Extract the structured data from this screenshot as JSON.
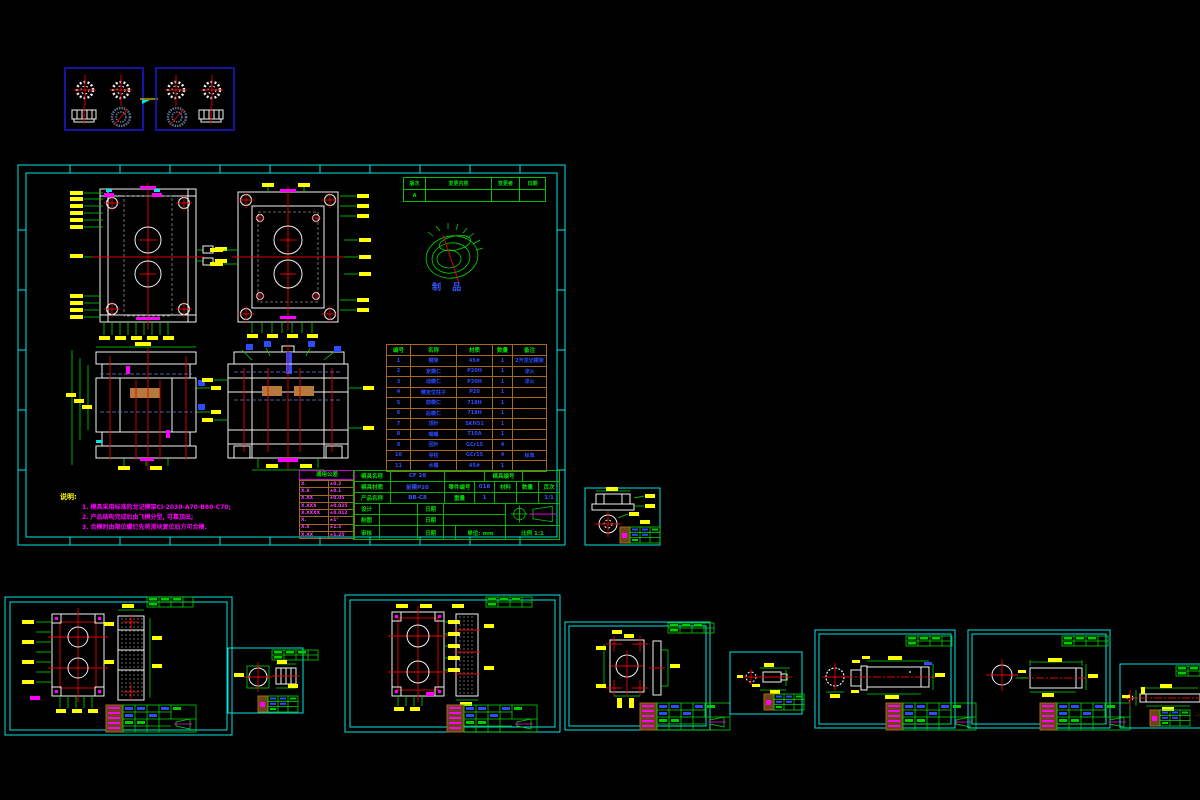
{
  "colors": {
    "background": "#000000",
    "sheet_border": "#00e5e5",
    "linework": "#f2f2f2",
    "dimension_lines": "#00d800",
    "dimension_text": "#ffff00",
    "centerline": "#e60000",
    "table_grid": "#a4671e",
    "bom_text": "#2e4bff",
    "note_text": "#ff00ff",
    "thumbnail_border": "#1a1acc"
  },
  "main_sheet": {
    "revision": {
      "headers": [
        "版次",
        "变更内容",
        "变更者",
        "日期"
      ],
      "rows": [
        [
          "A",
          "",
          "",
          ""
        ]
      ]
    },
    "product_label": "制 品",
    "bom": {
      "headers": [
        "编号",
        "名称",
        "材质",
        "数量",
        "备注"
      ],
      "rows": [
        [
          "1",
          "模架",
          "45#",
          "1",
          "2开龙记模架"
        ],
        [
          "2",
          "定模仁",
          "P20H",
          "1",
          "淬火"
        ],
        [
          "3",
          "动模仁",
          "P20H",
          "1",
          "淬火"
        ],
        [
          "4",
          "精定位柱子",
          "P20",
          "1",
          ""
        ],
        [
          "5",
          "前模仁",
          "718H",
          "1",
          ""
        ],
        [
          "6",
          "后模仁",
          "718H",
          "1",
          ""
        ],
        [
          "7",
          "顶针",
          "SKH51",
          "1",
          ""
        ],
        [
          "8",
          "唧嘴",
          "T10A",
          "1",
          ""
        ],
        [
          "9",
          "回针",
          "GCr15",
          "4",
          ""
        ],
        [
          "10",
          "导柱",
          "GCr15",
          "4",
          "标准"
        ],
        [
          "11",
          "水嘴",
          "45#",
          "1",
          ""
        ]
      ]
    },
    "notes": {
      "title": "说明:",
      "lines": [
        "1. 模具采用标准的龙记模架CI-2030-A70-B80-C70;",
        "2. 产品结构完成后由飞模分型, 可靠顶出;",
        "3. 合模时由限位螺钉先将滑块复位后方可合模."
      ]
    },
    "tolerance": {
      "title": "通用公差",
      "rows": [
        [
          "X.",
          "±0.2"
        ],
        [
          "X.X",
          "±0.1"
        ],
        [
          "X.XX",
          "±0.05"
        ],
        [
          "X.XXX",
          "±0.025"
        ],
        [
          "X.XXXX",
          "±0.012"
        ],
        [
          "X.",
          "±1°"
        ],
        [
          "X.X",
          "±1.5'"
        ],
        [
          "X.XX",
          "±1.25'"
        ]
      ]
    },
    "title_block": {
      "mold_name_label": "模具名称",
      "mold_name": "CF 28",
      "mold_no_label": "模具编号",
      "mold_mat_label": "模具材质",
      "mold_mat": "前模P20",
      "part_no_label": "零件编号",
      "part_no": "018",
      "product_name_label": "产品名称",
      "product_name": "BB-C8",
      "weight_label": "重量",
      "weight": "1",
      "col_material": "材料",
      "col_qty": "数量",
      "col_page": "页次",
      "page": "1/1",
      "design_label": "设计",
      "draft_label": "制图",
      "approve_label": "审核",
      "date_label": "日期",
      "unit_label": "单位: mm",
      "scale_label": "比例 1:1"
    }
  }
}
